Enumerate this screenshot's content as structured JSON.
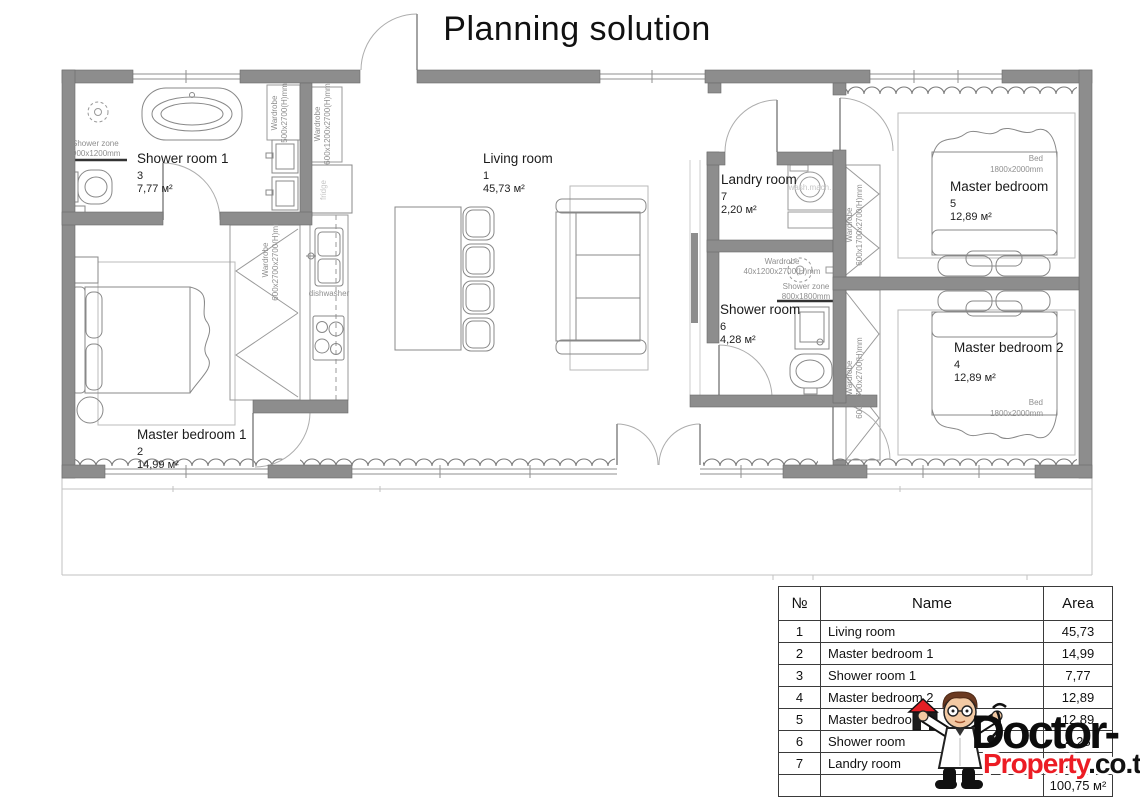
{
  "title": "Planning solution",
  "plan": {
    "wall_color": "#8d8d8d",
    "rooms": {
      "living": {
        "name": "Living room",
        "num": "1",
        "area": "45,73 м²"
      },
      "mb1": {
        "name": "Master bedroom 1",
        "num": "2",
        "area": "14,99 м²"
      },
      "sr1": {
        "name": "Shower room 1",
        "num": "3",
        "area": "7,77 м²"
      },
      "mb2": {
        "name": "Master bedroom 2",
        "num": "4",
        "area": "12,89 м²"
      },
      "mb": {
        "name": "Master bedroom",
        "num": "5",
        "area": "12,89 м²"
      },
      "sr": {
        "name": "Shower room",
        "num": "6",
        "area": "4,28 м²"
      },
      "landry": {
        "name": "Landry room",
        "num": "7",
        "area": "2,20 м²"
      }
    },
    "labels": {
      "wardrobe": "Wardrobe",
      "wardrobe_500": "500x2700(H)mm",
      "wardrobe_600_1200": "600x1200x2700(H)mm",
      "wardrobe_600_2700": "600x2700x2700(H)mm",
      "wardrobe_40_1200": "40x1200x2700(H)mm",
      "wardrobe_600_1700": "600x1700x2700(H)mm",
      "shower_zone": "Shower zone",
      "shower_zone_size_1": "900x1200mm",
      "shower_zone_size_2": "800x1800mm",
      "fridge": "fridge",
      "dishwasher": "dishwasher",
      "wash_mach": "wash.mach.",
      "bed": "Bed",
      "bed_size": "1800x2000mm"
    }
  },
  "table": {
    "headers": {
      "num": "№",
      "name": "Name",
      "area": "Area"
    },
    "rows": [
      {
        "num": "1",
        "name": "Living room",
        "area": "45,73"
      },
      {
        "num": "2",
        "name": "Master bedroom 1",
        "area": "14,99"
      },
      {
        "num": "3",
        "name": "Shower room 1",
        "area": "7,77"
      },
      {
        "num": "4",
        "name": "Master bedroom 2",
        "area": "12,89"
      },
      {
        "num": "5",
        "name": "Master bedroom",
        "area": "12,89"
      },
      {
        "num": "6",
        "name": "Shower room",
        "area": "4,28"
      },
      {
        "num": "7",
        "name": "Landry room",
        "area": "2,20"
      }
    ],
    "total_area": "100,75 м²"
  },
  "logo": {
    "brand_top": "Doctor-",
    "brand_red": "Property",
    "brand_suffix": ".co.th",
    "red": "#ec1c24"
  }
}
